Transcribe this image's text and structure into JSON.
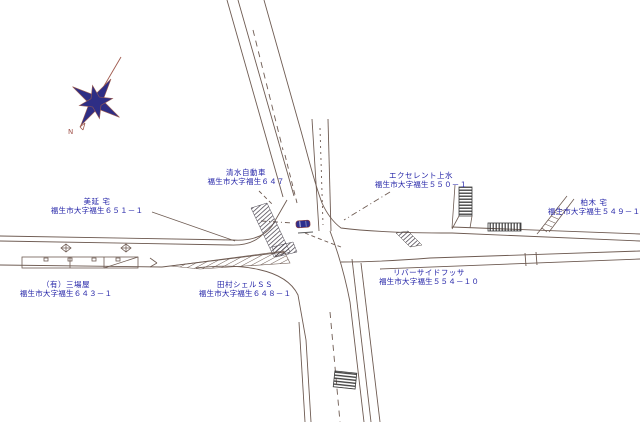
{
  "map": {
    "compass": {
      "label": "N"
    },
    "colors": {
      "line": "#6e5b52",
      "label_text": "#2424a8",
      "compass_fill": "#2e2e85",
      "compass_line": "#a05a4e",
      "vehicle_marker": "#2e2e8e",
      "hatch_dark": "#4a4550"
    },
    "labels": [
      {
        "name": "清水自動車",
        "address": "福生市大字福生６４７"
      },
      {
        "name": "エクセレント上水",
        "address": "福生市大字福生５５０－１"
      },
      {
        "name": "美延 宅",
        "address": "福生市大字福生６５１－１"
      },
      {
        "name": "（有）三場屋",
        "address": "福生市大字福生６４３－１"
      },
      {
        "name": "田村シェルＳＳ",
        "address": "福生市大字福生６４８－１"
      },
      {
        "name": "リバーサイドフッサ",
        "address": "福生市大字福生５５４－１０"
      },
      {
        "name": "柏木 宅",
        "address": "福生市大字福生５４９－１"
      }
    ]
  }
}
